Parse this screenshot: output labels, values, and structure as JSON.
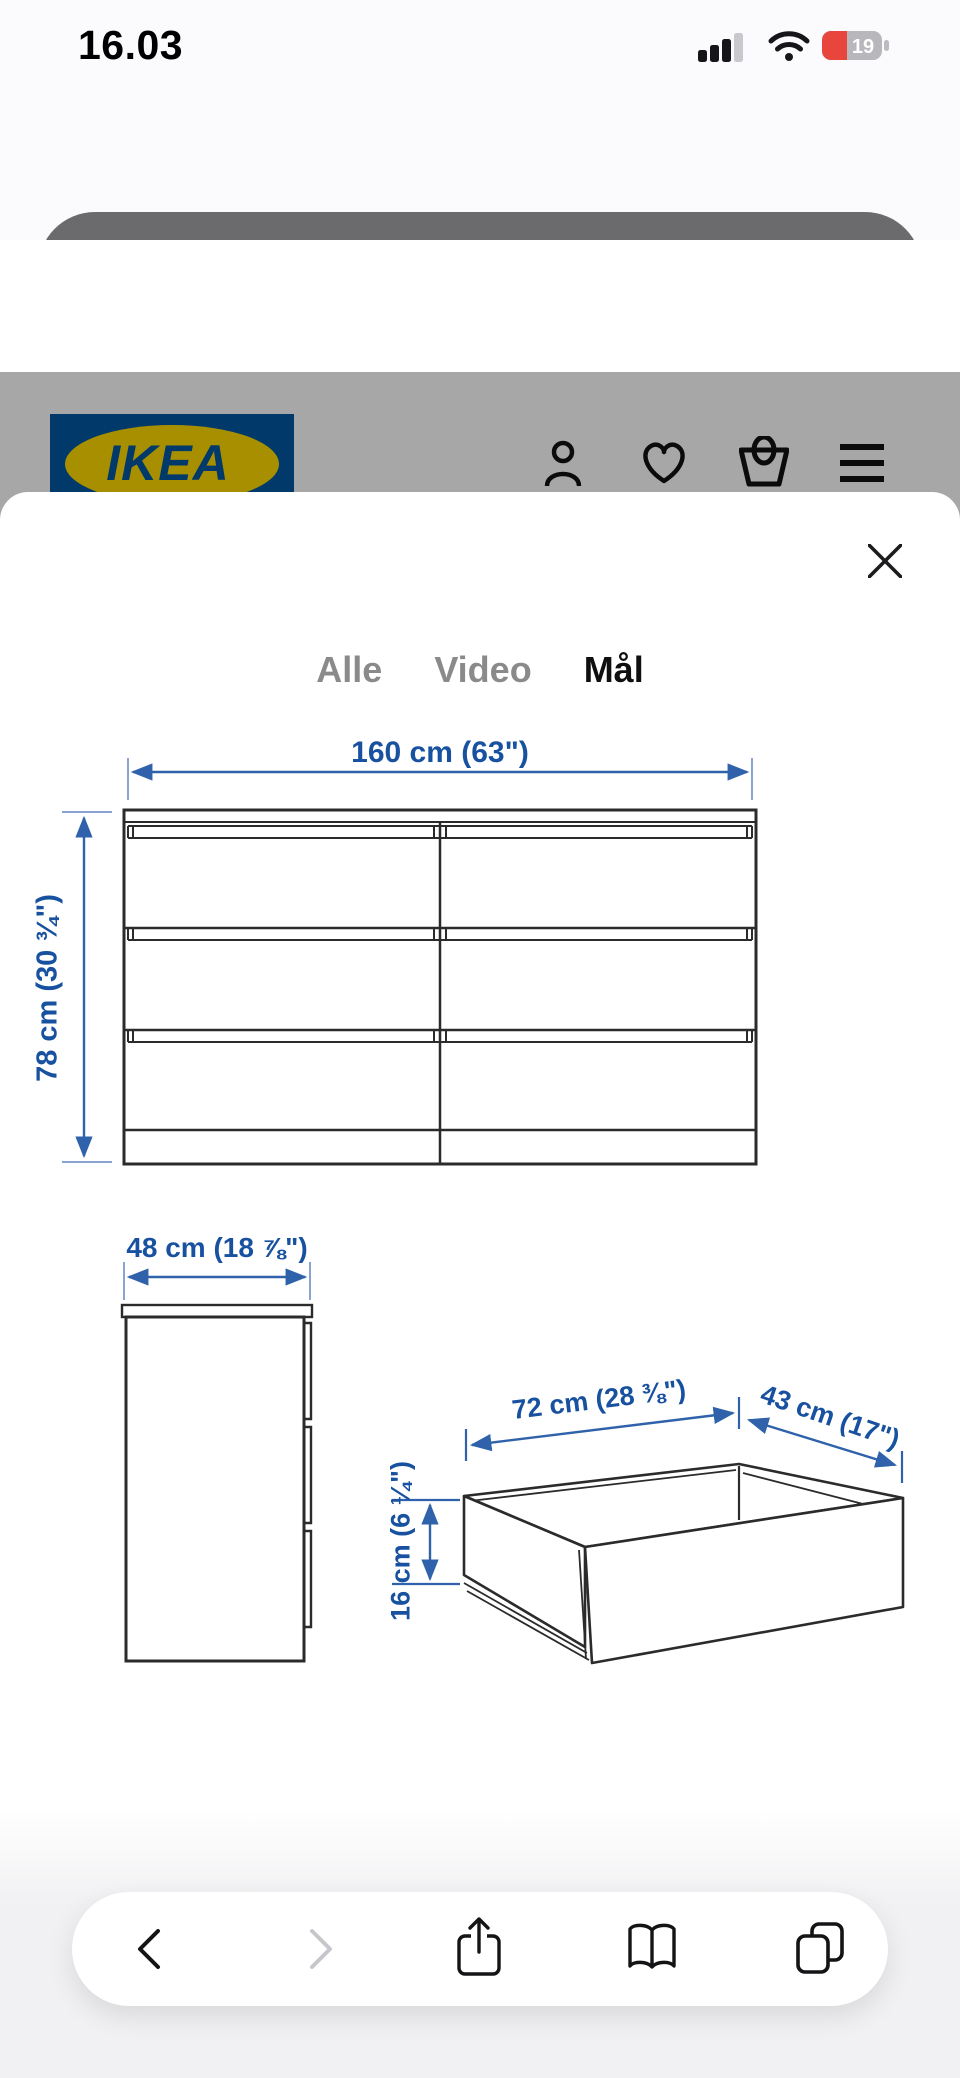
{
  "status_bar": {
    "time": "16.03",
    "battery_level": "19",
    "icons": [
      "cellular-signal-icon",
      "wifi-icon",
      "battery-icon"
    ],
    "battery_red": "#e8453c"
  },
  "url_bar": {
    "url": "ikea.com",
    "left_icon": "reader-page-icon",
    "right_icon": "reload-icon",
    "pill_color": "#6b6b6e"
  },
  "app_banner": {
    "app_name": "IKEA",
    "subtitle": "Åbn i appen IKEA",
    "open_button": "ÅBN",
    "app_icon_text": "IKEA",
    "button_color": "#0a7bff"
  },
  "site_header": {
    "logo_text": "IKEA",
    "registered_mark": "®",
    "icons": [
      "profile-icon",
      "favorites-heart-icon",
      "basket-icon",
      "menu-icon"
    ],
    "ikea_blue": "#0058a3",
    "ikea_yellow": "#ffdb00"
  },
  "media_viewer": {
    "close_icon": "close-x-icon",
    "tabs": [
      {
        "label": "Alle",
        "active": false
      },
      {
        "label": "Video",
        "active": false
      },
      {
        "label": "Mål",
        "active": true
      }
    ],
    "dimensions": {
      "width": "160 cm (63\")",
      "height": "78 cm (30 ¾\")",
      "depth": "48 cm (18 ⅞\")",
      "drawer_inner_width": "72 cm (28 ⅜\")",
      "drawer_inner_depth": "43 cm (17\")",
      "drawer_inner_height": "16 cm (6 ¼\")",
      "dimension_blue": "#17519f"
    }
  },
  "toolbar": {
    "icons": [
      "back-icon",
      "forward-icon",
      "share-icon",
      "bookmarks-icon",
      "tabs-icon"
    ],
    "forward_enabled": false
  }
}
